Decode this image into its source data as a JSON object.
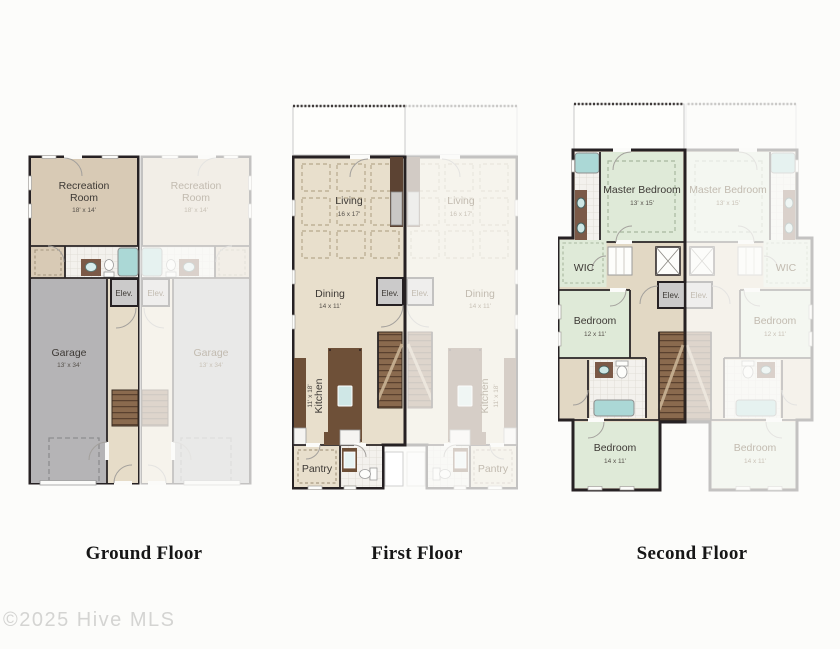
{
  "watermark": "©2025 Hive MLS",
  "floors": {
    "ground": {
      "title": "Ground Floor",
      "labels": {
        "recreation_line1": "Recreation",
        "recreation_line2": "Room",
        "recreation_dims": "18' x 14'",
        "garage": "Garage",
        "garage_dims": "13' x 34'",
        "elevator": "Elev."
      }
    },
    "first": {
      "title": "First Floor",
      "labels": {
        "living": "Living",
        "living_dims": "16 x 17'",
        "dining": "Dining",
        "dining_dims": "14 x 11'",
        "kitchen": "Kitchen",
        "kitchen_dims": "11' x 18'",
        "pantry": "Pantry",
        "elevator": "Elev."
      }
    },
    "second": {
      "title": "Second Floor",
      "labels": {
        "master_bedroom": "Master Bedroom",
        "master_bedroom_dims": "13' x 15'",
        "wic": "WIC",
        "bedroom_mid": "Bedroom",
        "bedroom_mid_dims": "12 x 11'",
        "bedroom_lower": "Bedroom",
        "bedroom_lower_dims": "14 x 11'",
        "elevator": "Elev."
      }
    }
  },
  "colors": {
    "wall": "#262123",
    "tan_room": "#d8cab5",
    "hall_tan": "#e2d8c4",
    "cream_floor": "#e8dfcc",
    "green_room": "#dfead8",
    "garage_gray": "#b5b4b6",
    "elevator_gray": "#cbcaca",
    "stair_brown": "#8a6a4e",
    "cabinet_brown": "#6e5038",
    "tub_teal": "#abd8d6",
    "tile_white": "#f2f0ec",
    "faded_label": "#c2bbb0"
  }
}
